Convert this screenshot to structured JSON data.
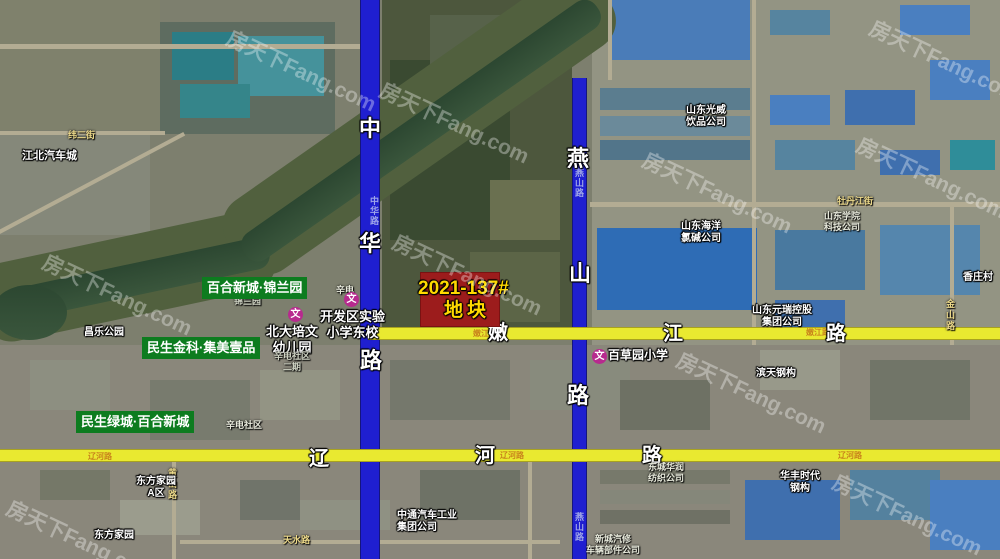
{
  "watermark": "房天下Fang.com",
  "parcel": {
    "code": "2021-137#",
    "name": "地块"
  },
  "roads": {
    "zhonghua": [
      "中",
      "华",
      "路"
    ],
    "yanshan": [
      "燕",
      "山",
      "路"
    ],
    "nenjiang": [
      "嫩",
      "江",
      "路"
    ],
    "liaohe": [
      "辽",
      "河",
      "路"
    ],
    "small": {
      "zhonghua": "中华路",
      "yanshan": "燕山路",
      "nenjiang": "嫩江路",
      "liaohe": "辽河路",
      "weier": "纬二街",
      "mudanjiang": "牡丹江街",
      "jinshan": "金山路",
      "huangshan": "黄山路",
      "tianshui": "天水路"
    }
  },
  "estates": [
    "百合新城·锦兰园",
    "民生金科·集美壹品",
    "民生绿城·百合新城"
  ],
  "schools": {
    "icon": "文",
    "names": [
      "北大培文\n幼儿园",
      "开发区实验\n小学东校",
      "百草园小学"
    ]
  },
  "places": [
    "江北汽车城",
    "昌乐公园",
    "山东光威\n饮品公司",
    "山东海洋\n氯碱公司",
    "山东元瑞控股\n集团公司",
    "滨天钢构",
    "山东学院\n科技公司",
    "香庄村",
    "东方家园\nA区",
    "东方家园",
    "中通汽车工业\n集团公司",
    "新城汽修\n车辆部件公司",
    "东城华润\n纺织公司",
    "华丰时代\n钢构",
    "锦兰园",
    "辛电",
    "辛电社区\n二期",
    "辛电社区"
  ]
}
